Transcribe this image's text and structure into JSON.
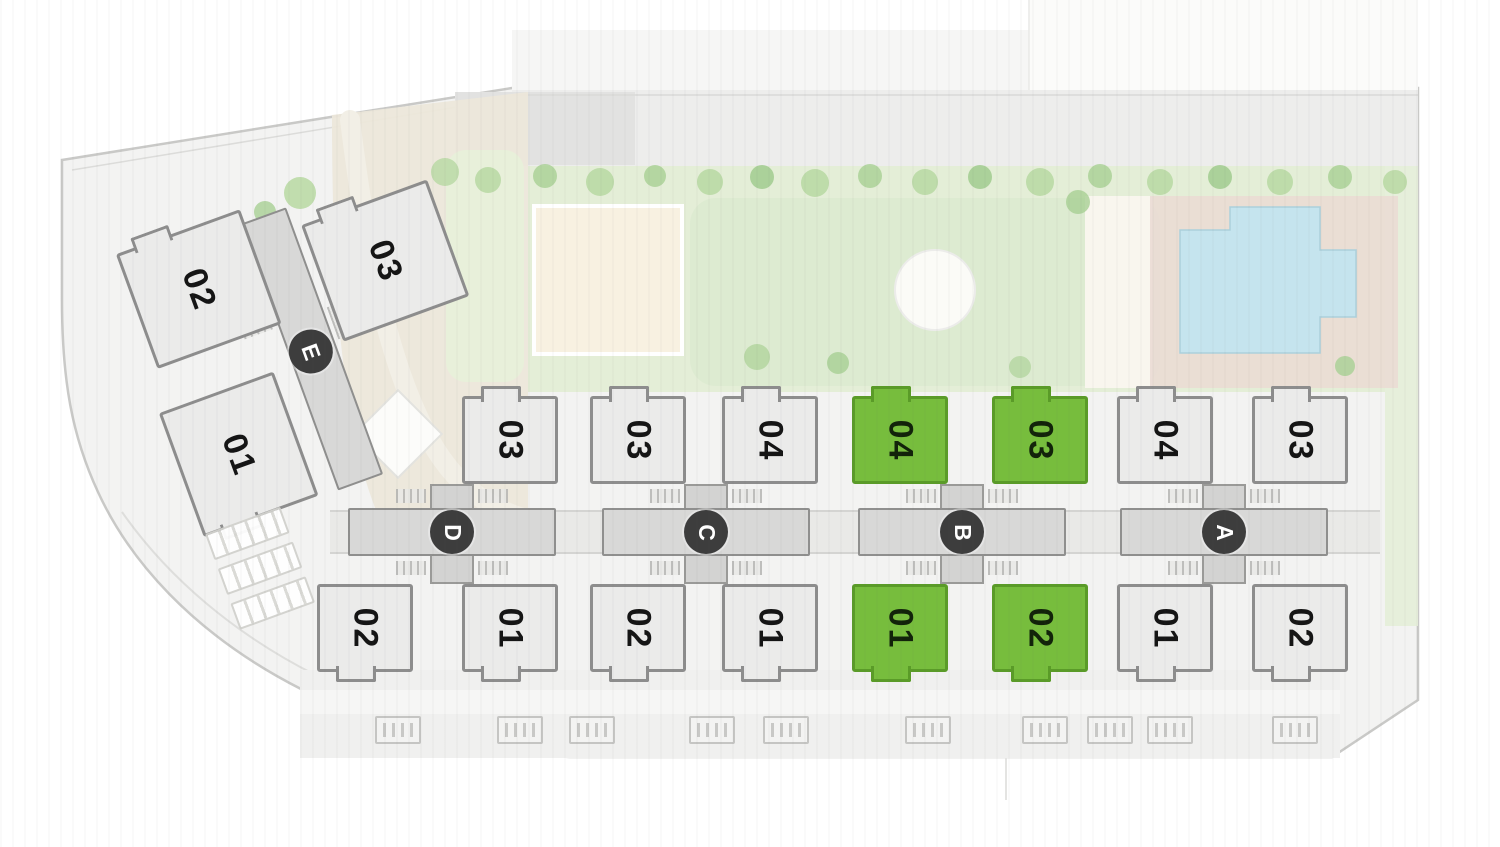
{
  "site_plan": {
    "canvas": {
      "width": 1500,
      "height": 847
    },
    "colors": {
      "background": "#ffffff",
      "plan_fill": "#f3f3f2",
      "boundary": "#c9c9c7",
      "unit_fill": "#ebebea",
      "unit_border": "#8d8d8d",
      "unit_selected_fill": "#77bd3d",
      "unit_selected_border": "#5a9b28",
      "corridor_fill": "#d8d8d7",
      "corridor_border": "#8f8f8e",
      "core_circle_fill": "#3d3d3d",
      "core_circle_text": "#ffffff",
      "unit_number_color": "#151515",
      "lawn": "#e4eed7",
      "tree": "#b7d8a2",
      "path_beige": "#ece7da",
      "deck_cream": "#f8f1e1",
      "pool_water": "#c5e4ee",
      "pool_deck": "#eadcd4"
    },
    "geometry": {
      "unit_w": 96,
      "unit_h": 88,
      "top_row_y": 396,
      "bottom_row_y": 584,
      "corridor": {
        "w": 208,
        "y": 508,
        "h": 48
      },
      "core_link": {
        "w": 44,
        "y": 484,
        "h": 100
      },
      "core_circle": {
        "cy": 532,
        "r": 22
      },
      "hatch": {
        "w": 30,
        "h": 14,
        "top_y": 489,
        "bottom_y": 561
      },
      "connectors": [
        [
          330,
          350
        ],
        [
          556,
          602
        ],
        [
          810,
          858
        ],
        [
          1066,
          1120
        ],
        [
          1328,
          1380
        ]
      ]
    },
    "buildings": [
      {
        "id": "D",
        "core_label": "D",
        "cx": 452,
        "units": [
          {
            "label": "03",
            "row": "top",
            "cx": 510,
            "selected": false
          },
          {
            "label": "02",
            "row": "bottom",
            "cx": 365,
            "selected": false
          },
          {
            "label": "01",
            "row": "bottom",
            "cx": 510,
            "selected": false
          }
        ]
      },
      {
        "id": "C",
        "core_label": "C",
        "cx": 706,
        "units": [
          {
            "label": "03",
            "row": "top",
            "cx": 638,
            "selected": false
          },
          {
            "label": "04",
            "row": "top",
            "cx": 770,
            "selected": false
          },
          {
            "label": "02",
            "row": "bottom",
            "cx": 638,
            "selected": false
          },
          {
            "label": "01",
            "row": "bottom",
            "cx": 770,
            "selected": false
          }
        ]
      },
      {
        "id": "B",
        "core_label": "B",
        "cx": 962,
        "units": [
          {
            "label": "04",
            "row": "top",
            "cx": 900,
            "selected": true
          },
          {
            "label": "03",
            "row": "top",
            "cx": 1040,
            "selected": true
          },
          {
            "label": "01",
            "row": "bottom",
            "cx": 900,
            "selected": true
          },
          {
            "label": "02",
            "row": "bottom",
            "cx": 1040,
            "selected": true
          }
        ]
      },
      {
        "id": "A",
        "core_label": "A",
        "cx": 1224,
        "units": [
          {
            "label": "04",
            "row": "top",
            "cx": 1165,
            "selected": false
          },
          {
            "label": "03",
            "row": "top",
            "cx": 1300,
            "selected": false
          },
          {
            "label": "01",
            "row": "bottom",
            "cx": 1165,
            "selected": false
          },
          {
            "label": "02",
            "row": "bottom",
            "cx": 1300,
            "selected": false
          }
        ]
      },
      {
        "id": "E",
        "core_label": "E",
        "rotated": true
      }
    ],
    "building_e": {
      "left": 140,
      "top": 190,
      "width": 340,
      "height": 330,
      "rotation_deg": -20,
      "corridor": {
        "x": 150,
        "y": 18,
        "w": 48,
        "h": 284
      },
      "core_circle": {
        "cx": 172,
        "cy": 162,
        "r": 22
      },
      "hatches": [
        {
          "x": 114,
          "y": 94,
          "w": 30,
          "h": 34
        },
        {
          "x": 202,
          "y": 126,
          "w": 30,
          "h": 34
        }
      ],
      "units": [
        {
          "label": "02",
          "x": 22,
          "y": 4,
          "w": 132,
          "h": 122,
          "tab": "top",
          "selected": false
        },
        {
          "label": "03",
          "x": 206,
          "y": 40,
          "w": 134,
          "h": 124,
          "tab": "top",
          "selected": false
        },
        {
          "label": "01",
          "x": 8,
          "y": 168,
          "w": 122,
          "h": 132,
          "tab": "bottom",
          "selected": false
        }
      ]
    },
    "parking": {
      "left": 205,
      "top": 534,
      "rotation_deg": -20,
      "row_count": 3
    },
    "vents": {
      "y": 716,
      "w": 46,
      "h": 28,
      "centers": [
        398,
        520,
        592,
        712,
        786,
        928,
        1045,
        1110,
        1170,
        1295
      ]
    }
  }
}
